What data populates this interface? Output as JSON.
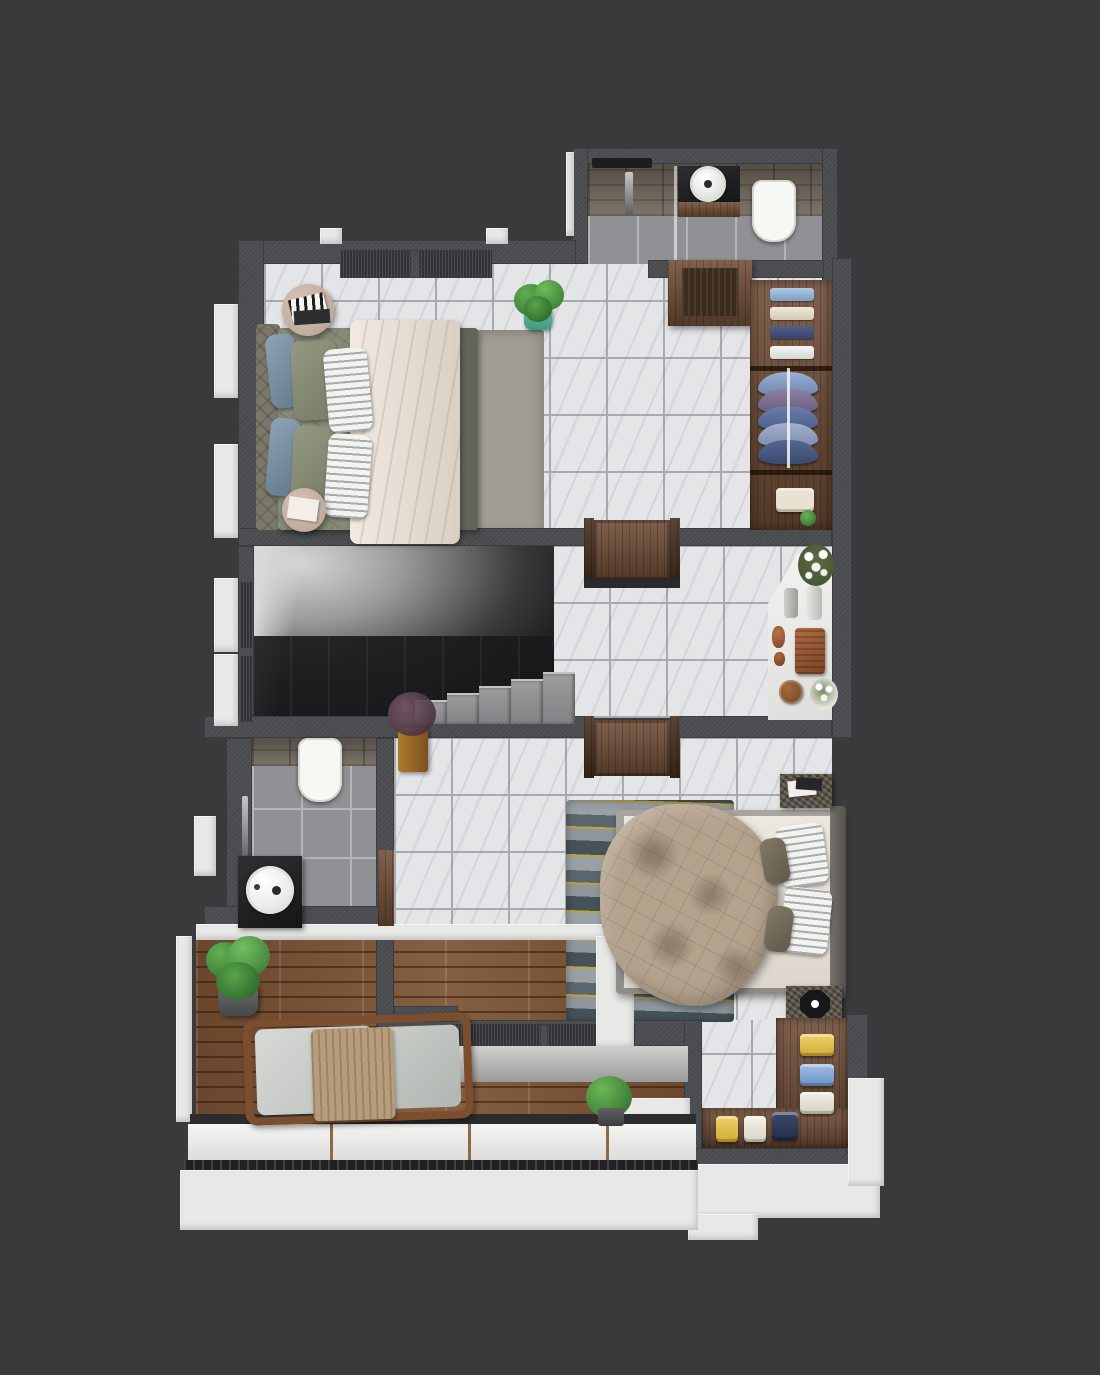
{
  "palette": {
    "bg": "#3a3a3c",
    "wall": "#4b4c4f",
    "wall-dark": "#333437",
    "sill": "#323337",
    "white-ext": "#e8e8e6",
    "marble": "#e4e5e7",
    "grout": "#a8aaae",
    "graytile": "#909194",
    "gt-grout": "#b4b5b7",
    "stone": "#756c60",
    "wood": "#7d5334",
    "walnut": "#6e4b34",
    "walnut-dark": "#432c1b",
    "porcelain": "#f7f7f4",
    "granite": "#564f43",
    "sage": "#878b78",
    "sage-dark": "#62635a",
    "headboard": "#7b7869",
    "cream-blanket": "#e7dccf",
    "blue-pillow": "#7e93a8",
    "rug1": "#a19c94",
    "rug2-navy": "#46525a",
    "rug2-gray": "#8e979b",
    "rug2-gold": "#c0a23f",
    "tan-duvet": "#b4a28c",
    "teal-pot": "#63c0a2",
    "plant-green": "#4c9a41",
    "plant-dark": "#2e6b2a",
    "terracotta": "#9c5c3a",
    "dried-maroon": "#5e4452",
    "towel-blue": "#9cbbdc",
    "towel-navy": "#44517a",
    "towel-cream": "#e9e1d1",
    "towel-white": "#eef0ee",
    "fold-yellow": "#e7c351",
    "fold-lightblue": "#87abd6",
    "fold-navy": "#2e3a58",
    "chair-cushion": "#cdd0cc",
    "throw-tan": "#b79d7b",
    "void-dark": "#121214"
  },
  "scene": {
    "type": "3d-floor-plan-render",
    "view": "top-down dollhouse cutaway",
    "rooms": [
      {
        "name": "bathroom-top",
        "floor": "gray-tile",
        "fixtures": [
          "shower-rail",
          "round-basin-vanity",
          "wood-drawer",
          "toilet"
        ]
      },
      {
        "name": "master-bedroom",
        "floor": "marble-tile",
        "furniture": [
          "double-bed",
          "upholstered-headboard",
          "cream-throw-blanket",
          "striped-pillows",
          "blue-pillows",
          "round-side-table-with-books",
          "round-side-table-with-book",
          "potted-plant-teal-pot",
          "gray-rug",
          "dresser",
          "open-wardrobe"
        ]
      },
      {
        "name": "master-wardrobe",
        "contents": [
          "folded-towels",
          "hanging-shirts",
          "folded-clothes",
          "small-plant"
        ]
      },
      {
        "name": "stair-hall",
        "floor": "marble-tile",
        "features": [
          "staircase-down",
          "granite-steps",
          "wooden-door-top",
          "wooden-door-bottom",
          "marble-console",
          "flower-vases",
          "terracotta-sculpture",
          "decor-plate"
        ]
      },
      {
        "name": "bedroom-2",
        "floor": "marble-tile",
        "furniture": [
          "double-bed",
          "tan-crumpled-duvet",
          "striped-pillows",
          "nightstand-with-books",
          "nightstand-with-faceted-lamp",
          "wavy-navy-gold-rug",
          "dried-flower-box-vase"
        ]
      },
      {
        "name": "bathroom-2",
        "floor": "gray-tile",
        "fixtures": [
          "toilet",
          "round-stone-basin",
          "dark-counter",
          "shower-column",
          "wood-door-frame"
        ]
      },
      {
        "name": "balcony",
        "floor": "wood-deck",
        "furniture": [
          "lounge-chair-with-throw",
          "potted-plant"
        ],
        "features": [
          "glass-parapet",
          "white-ledge"
        ]
      },
      {
        "name": "walk-in-closet",
        "floor": "marble-tile",
        "furniture": [
          "l-shaped-wardrobe"
        ],
        "contents": [
          "yellow-blue-white-folded-clothes"
        ]
      }
    ]
  }
}
